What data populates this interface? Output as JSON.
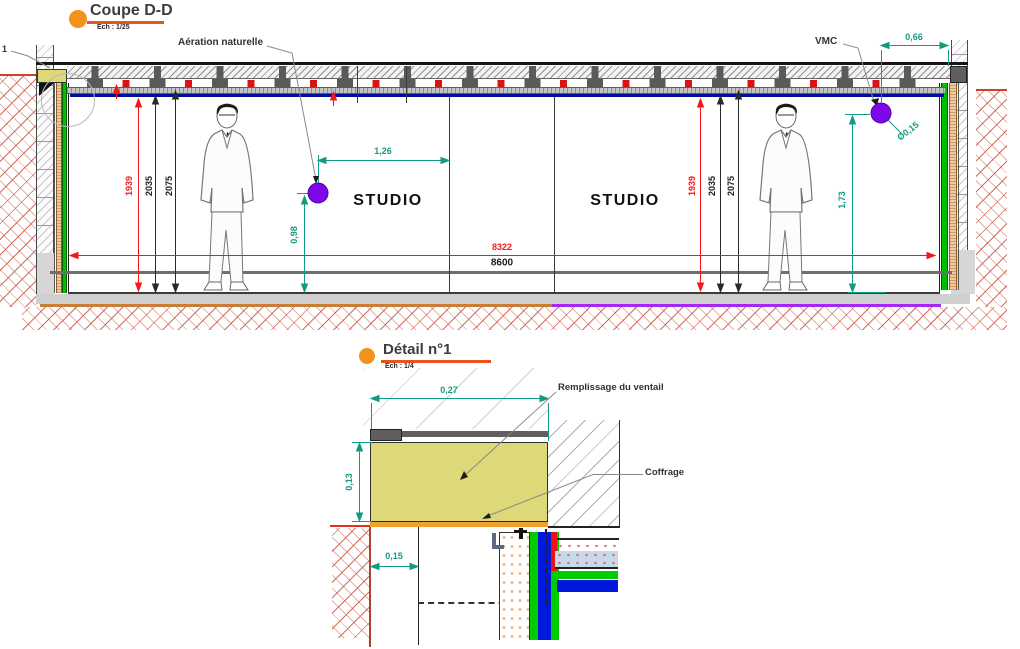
{
  "coupe": {
    "title": "Coupe D-D",
    "scale": "Ech : 1/25",
    "callout_number": "1",
    "labels": {
      "aeration": "Aération naturelle",
      "vmc": "VMC"
    },
    "rooms": {
      "left": "STUDIO",
      "right": "STUDIO"
    },
    "dims": {
      "h_red": "1939",
      "h_mid": "2035",
      "h_top": "2075",
      "w_inner": "8322",
      "w_outer": "8600",
      "aeration_offset": "1,26",
      "aeration_height": "0,98",
      "vmc_offset": "0,66",
      "vmc_diameter": "Ø0,15",
      "vmc_height": "1,73"
    }
  },
  "detail": {
    "title": "Détail n°1",
    "scale": "Ech : 1/4",
    "labels": {
      "remplissage": "Remplissage du ventail",
      "coffrage": "Coffrage"
    },
    "dims": {
      "width": "0,27",
      "height": "0,13",
      "offset": "0,15"
    }
  },
  "colors": {
    "accent_orange": "#f2921d",
    "underline_orange": "#e8551c",
    "dim_teal": "#119b82",
    "dim_red": "#f81616",
    "duct_purple": "#7c08e8",
    "floor_purple": "#a428f0",
    "block_yellow": "#ddd878",
    "membrane_green": "#00bf00",
    "membrane_blue": "#0018dd"
  }
}
